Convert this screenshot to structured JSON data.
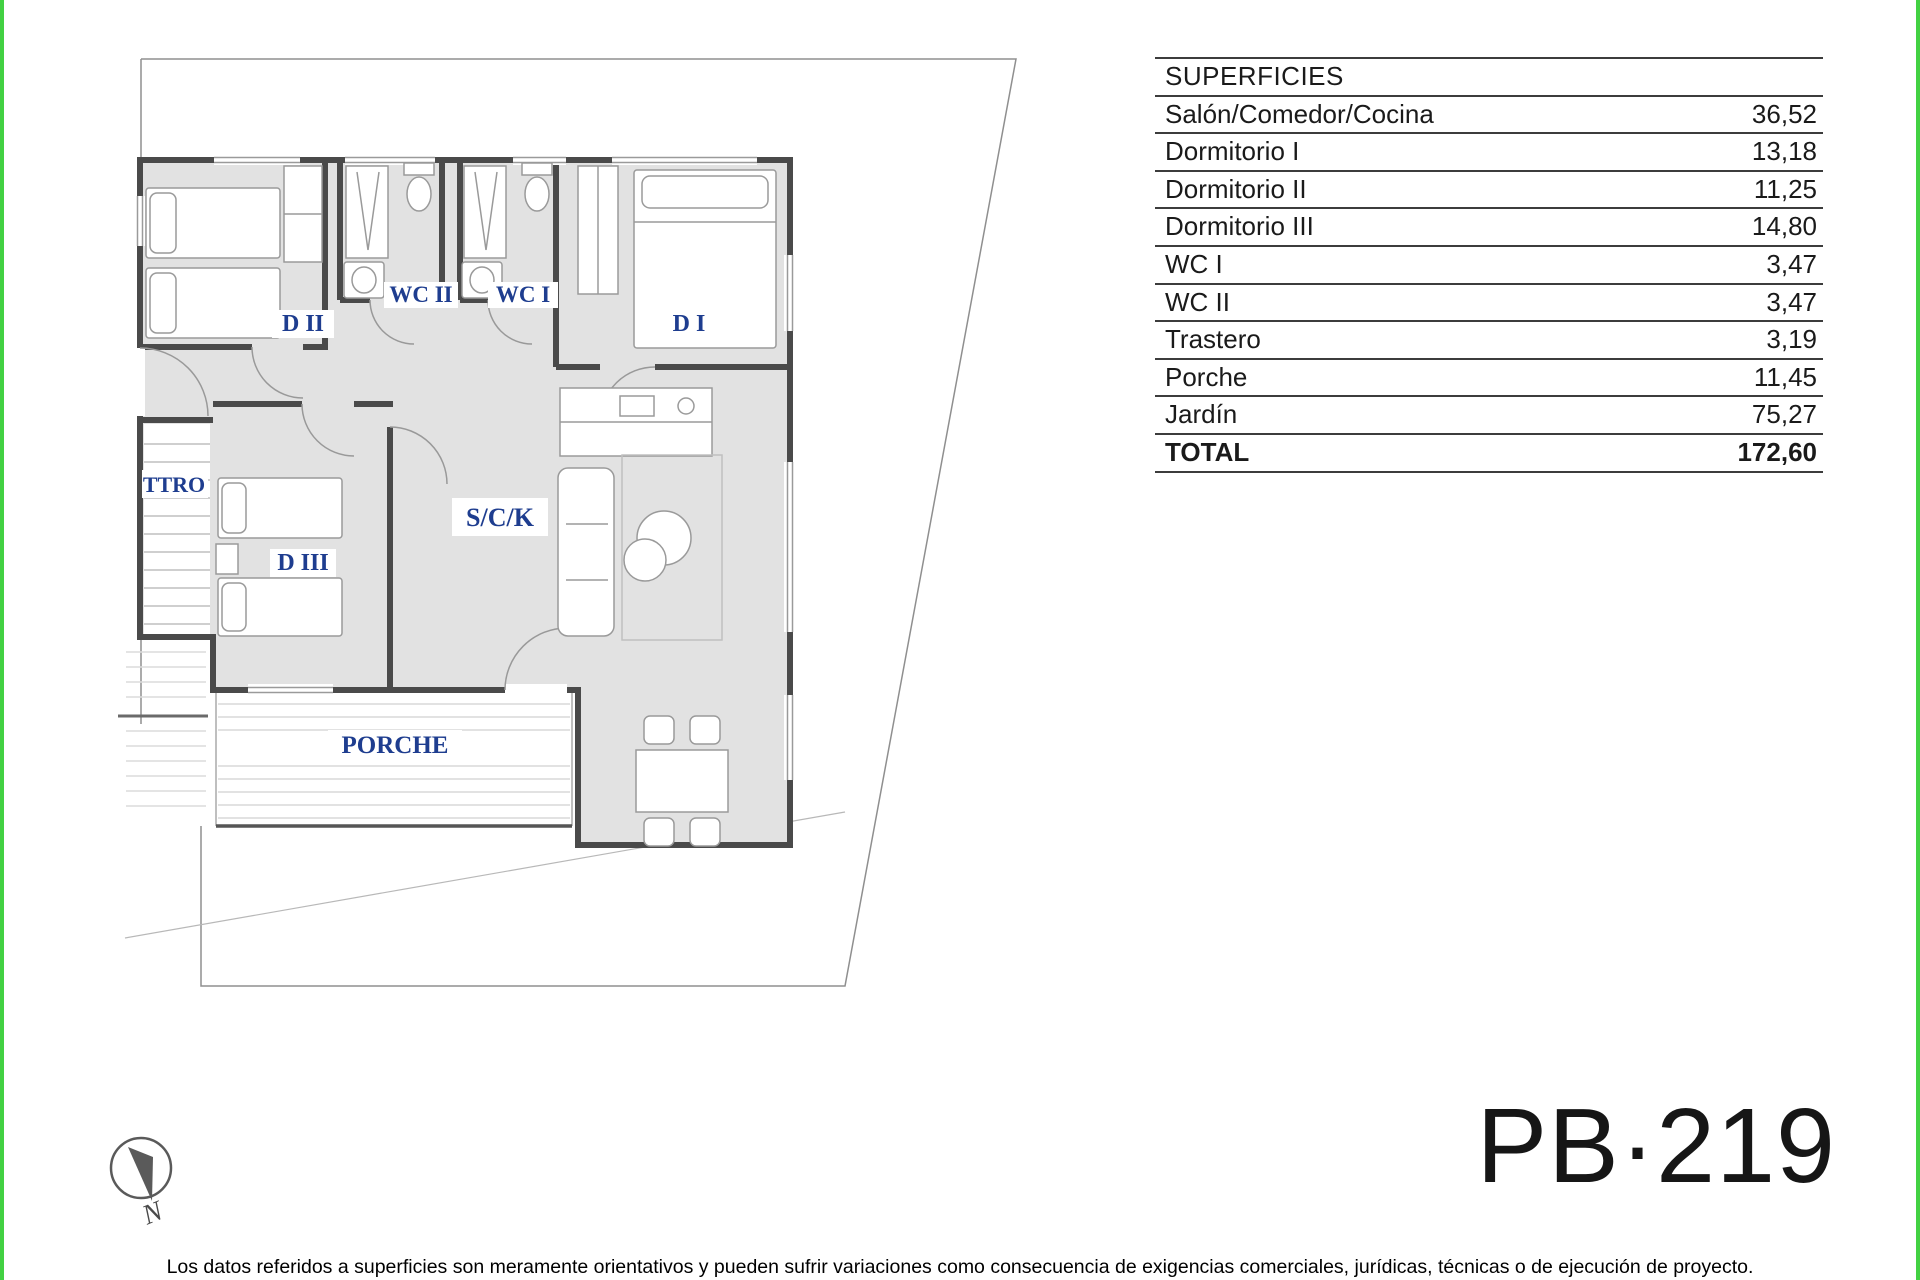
{
  "table": {
    "header": "SUPERFICIES",
    "rows": [
      {
        "label": "Salón/Comedor/Cocina",
        "value": "36,52"
      },
      {
        "label": "Dormitorio I",
        "value": "13,18"
      },
      {
        "label": "Dormitorio II",
        "value": "11,25"
      },
      {
        "label": "Dormitorio III",
        "value": "14,80"
      },
      {
        "label": "WC I",
        "value": "3,47"
      },
      {
        "label": "WC II",
        "value": "3,47"
      },
      {
        "label": "Trastero",
        "value": "3,19"
      },
      {
        "label": "Porche",
        "value": "11,45"
      },
      {
        "label": "Jardín",
        "value": "75,27"
      }
    ],
    "total": {
      "label": "TOTAL",
      "value": "172,60"
    }
  },
  "plan": {
    "labels": {
      "d2": "D II",
      "wc2": "WC II",
      "wc1": "WC I",
      "d1": "D I",
      "ttro": "TTRO",
      "d3": "D III",
      "sck": "S/C/K",
      "porche": "PORCHE"
    },
    "compass_n": "N"
  },
  "plan_code": "PB·219",
  "disclaimer": "Los datos referidos a superficies son meramente orientativos y pueden sufrir variaciones como consecuencia de exigencias comerciales, jurídicas, técnicas o de ejecución de proyecto.",
  "colors": {
    "accent_green": "#42d142",
    "label_blue": "#1e3d8f"
  }
}
